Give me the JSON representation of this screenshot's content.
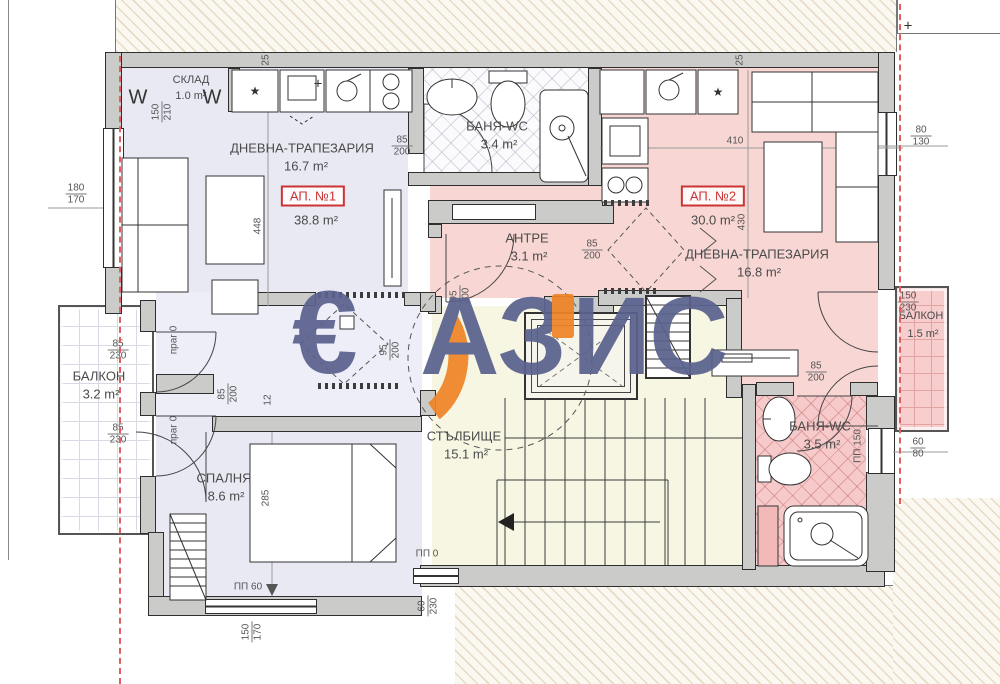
{
  "watermark": {
    "euro": "€",
    "part1": "АЗ",
    "part2": "ИС"
  },
  "icons": {
    "star": "★",
    "hook": "W",
    "cross": "+"
  },
  "apartments": [
    {
      "label": "АП. №1",
      "area": "38.8 m²"
    },
    {
      "label": "АП. №2",
      "area": "30.0 m²"
    }
  ],
  "rooms": {
    "sklad": {
      "name": "СКЛАД",
      "area": "1.0 m²"
    },
    "living1": {
      "name": "ДНЕВНА-ТРАПЕЗАРИЯ",
      "area": "16.7 m²"
    },
    "bath1": {
      "name": "БАНЯ-WC",
      "area": "3.4 m²"
    },
    "antre": {
      "name": "АНТРЕ",
      "area": "3.1 m²"
    },
    "living2": {
      "name": "ДНЕВНА-ТРАПЕЗАРИЯ",
      "area": "16.8 m²"
    },
    "balcony2": {
      "name": "БАЛКОН",
      "area": "1.5 m²"
    },
    "balcony1": {
      "name": "БАЛКОН",
      "area": "3.2 m²"
    },
    "bedroom": {
      "name": "СПАЛНЯ",
      "area": "8.6 m²"
    },
    "stairs": {
      "name": "СТЪЛБИЩЕ",
      "area": "15.1 m²"
    },
    "bath2": {
      "name": "БАНЯ-WC",
      "area": "3.5 m²"
    }
  },
  "dims": [
    {
      "t": "150",
      "b": "210"
    },
    {
      "v": "25"
    },
    {
      "v": "25"
    },
    {
      "t": "85",
      "b": "200"
    },
    {
      "t": "180",
      "b": "170"
    },
    {
      "v": "448"
    },
    {
      "v": "410"
    },
    {
      "v": "430"
    },
    {
      "t": "80",
      "b": "130"
    },
    {
      "t": "85",
      "b": "200"
    },
    {
      "t": "95",
      "b": "200"
    },
    {
      "t": "95",
      "b": "200"
    },
    {
      "t": "150",
      "b": "230"
    },
    {
      "t": "85",
      "b": "230"
    },
    {
      "t": "85",
      "b": "230"
    },
    {
      "t": "85",
      "b": "200"
    },
    {
      "v": "12"
    },
    {
      "t": "85",
      "b": "200"
    },
    {
      "v": "285"
    },
    {
      "t": "150",
      "b": "170"
    },
    {
      "t": "60",
      "b": "230"
    },
    {
      "t": "60",
      "b": "80"
    },
    {
      "v": "ПП 60"
    },
    {
      "v": "ПП 0"
    },
    {
      "v": "ПП 150"
    },
    {
      "v": "праг 0"
    },
    {
      "v": "праг 0"
    }
  ],
  "colors": {
    "apartment1_fill": "#e9e9f4",
    "apartment2_fill": "#f7d6d4",
    "stairs_fill": "#f7f6e2",
    "wall": "#cbcbc9",
    "apartment_badge_red": "#cc3434",
    "boundary_dashed_red": "#e06060",
    "watermark_blue": "#5b628e",
    "watermark_orange": "#ef8427"
  }
}
